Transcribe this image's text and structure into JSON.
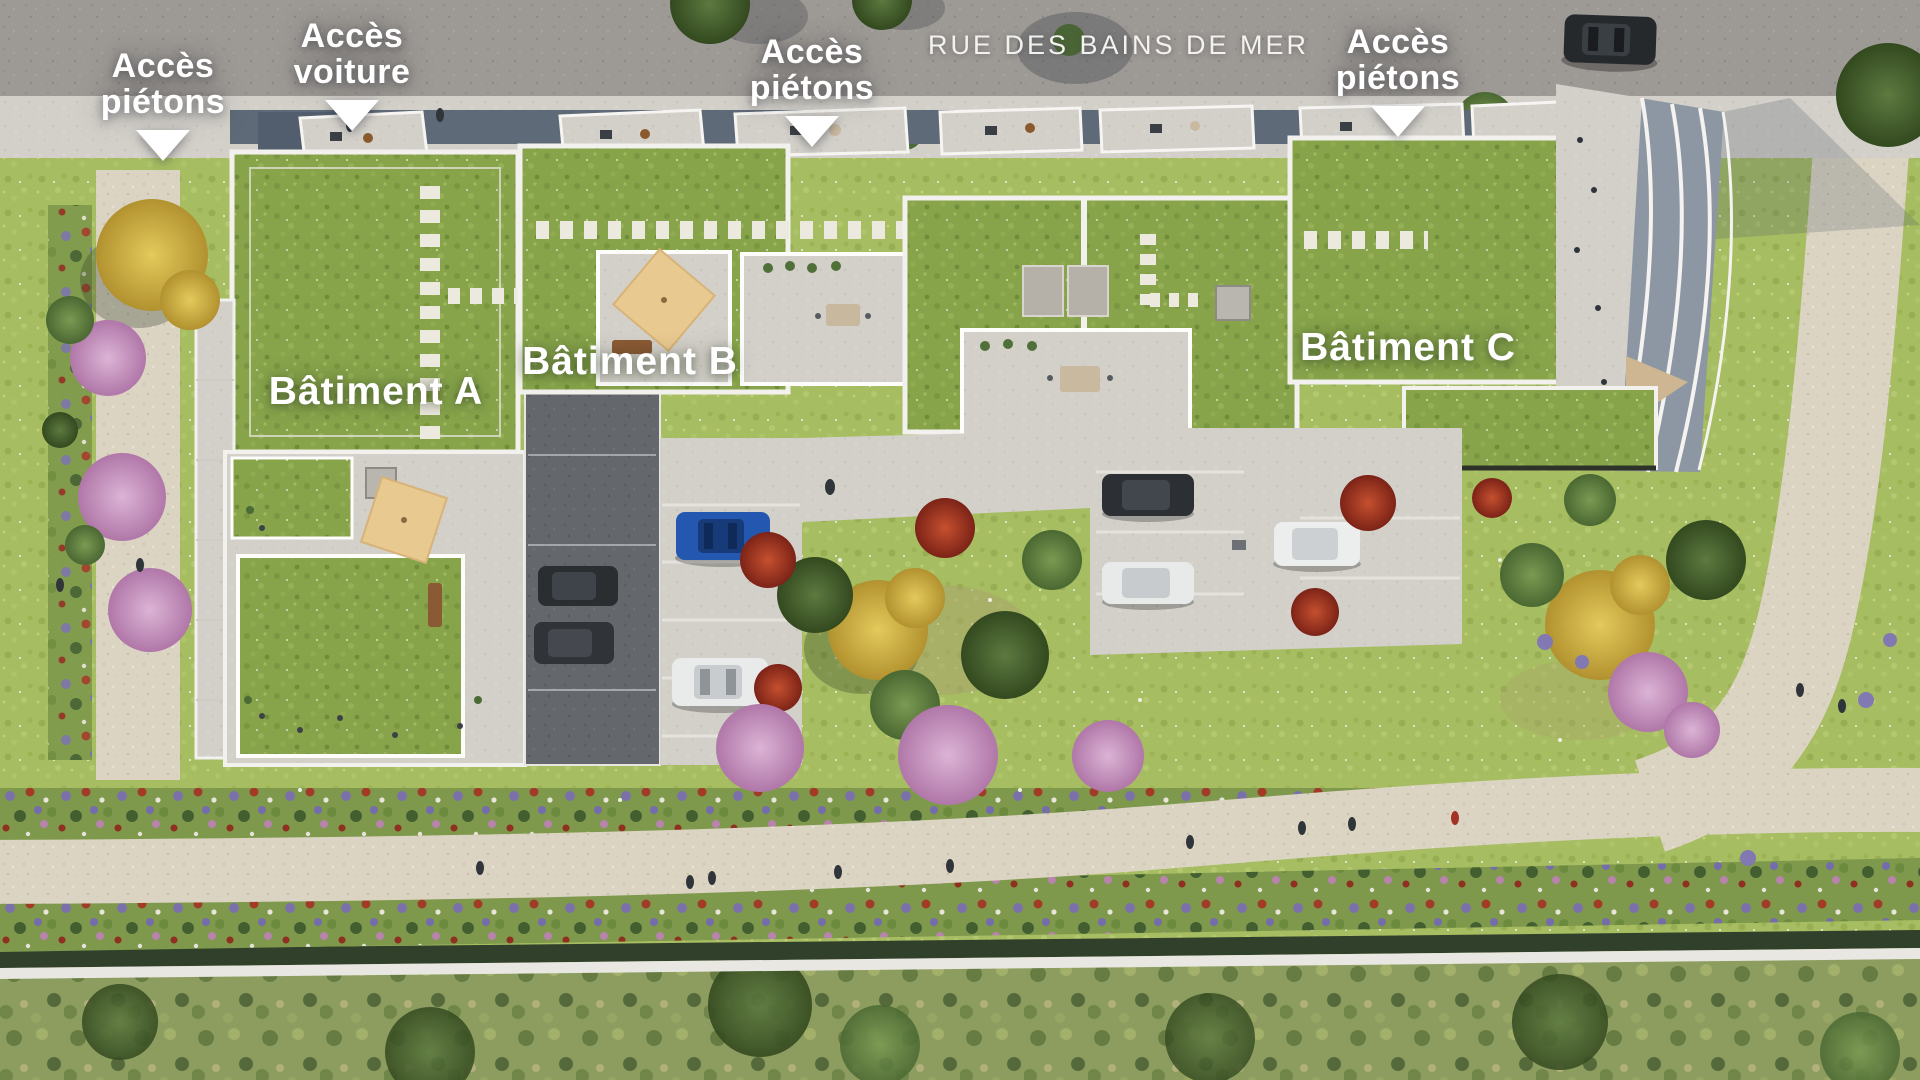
{
  "scene": {
    "description": "Aerial 3D masterplan render of a residential development with three green-roofed buildings, inner courtyard parking, gardens and pedestrian paths",
    "street": {
      "name": "RUE DES BAINS DE MER"
    },
    "access_points": [
      {
        "id": "pedestrian-left",
        "label": "Accès piétons",
        "marker": "down-arrow"
      },
      {
        "id": "car",
        "label": "Accès voiture",
        "marker": "down-arrow"
      },
      {
        "id": "pedestrian-center",
        "label": "Accès piétons",
        "marker": "down-arrow"
      },
      {
        "id": "pedestrian-right",
        "label": "Accès piétons",
        "marker": "down-arrow"
      }
    ],
    "buildings": [
      {
        "id": "a",
        "label": "Bâtiment A"
      },
      {
        "id": "b",
        "label": "Bâtiment B"
      },
      {
        "id": "c",
        "label": "Bâtiment C"
      }
    ],
    "colors": {
      "label_text": "#ffffff",
      "street_text": "#f3f2ef",
      "road_asphalt": "#9d9995",
      "sidewalk": "#d3d0ca",
      "gravel_path": "#dcd4c3",
      "lawn": "#a6bd62",
      "green_roof": "#87a44b",
      "facade_blue_gray": "#5e6a78",
      "driveway_dark": "#64676b",
      "tree_pink": "#c08bb8",
      "tree_yellow": "#d4b445",
      "flower_red": "#a83a24",
      "car_blue": "#2457b0",
      "car_white": "#e9eaea",
      "car_dark": "#2b2e31",
      "parasol_beige": "#e8c98f"
    }
  }
}
